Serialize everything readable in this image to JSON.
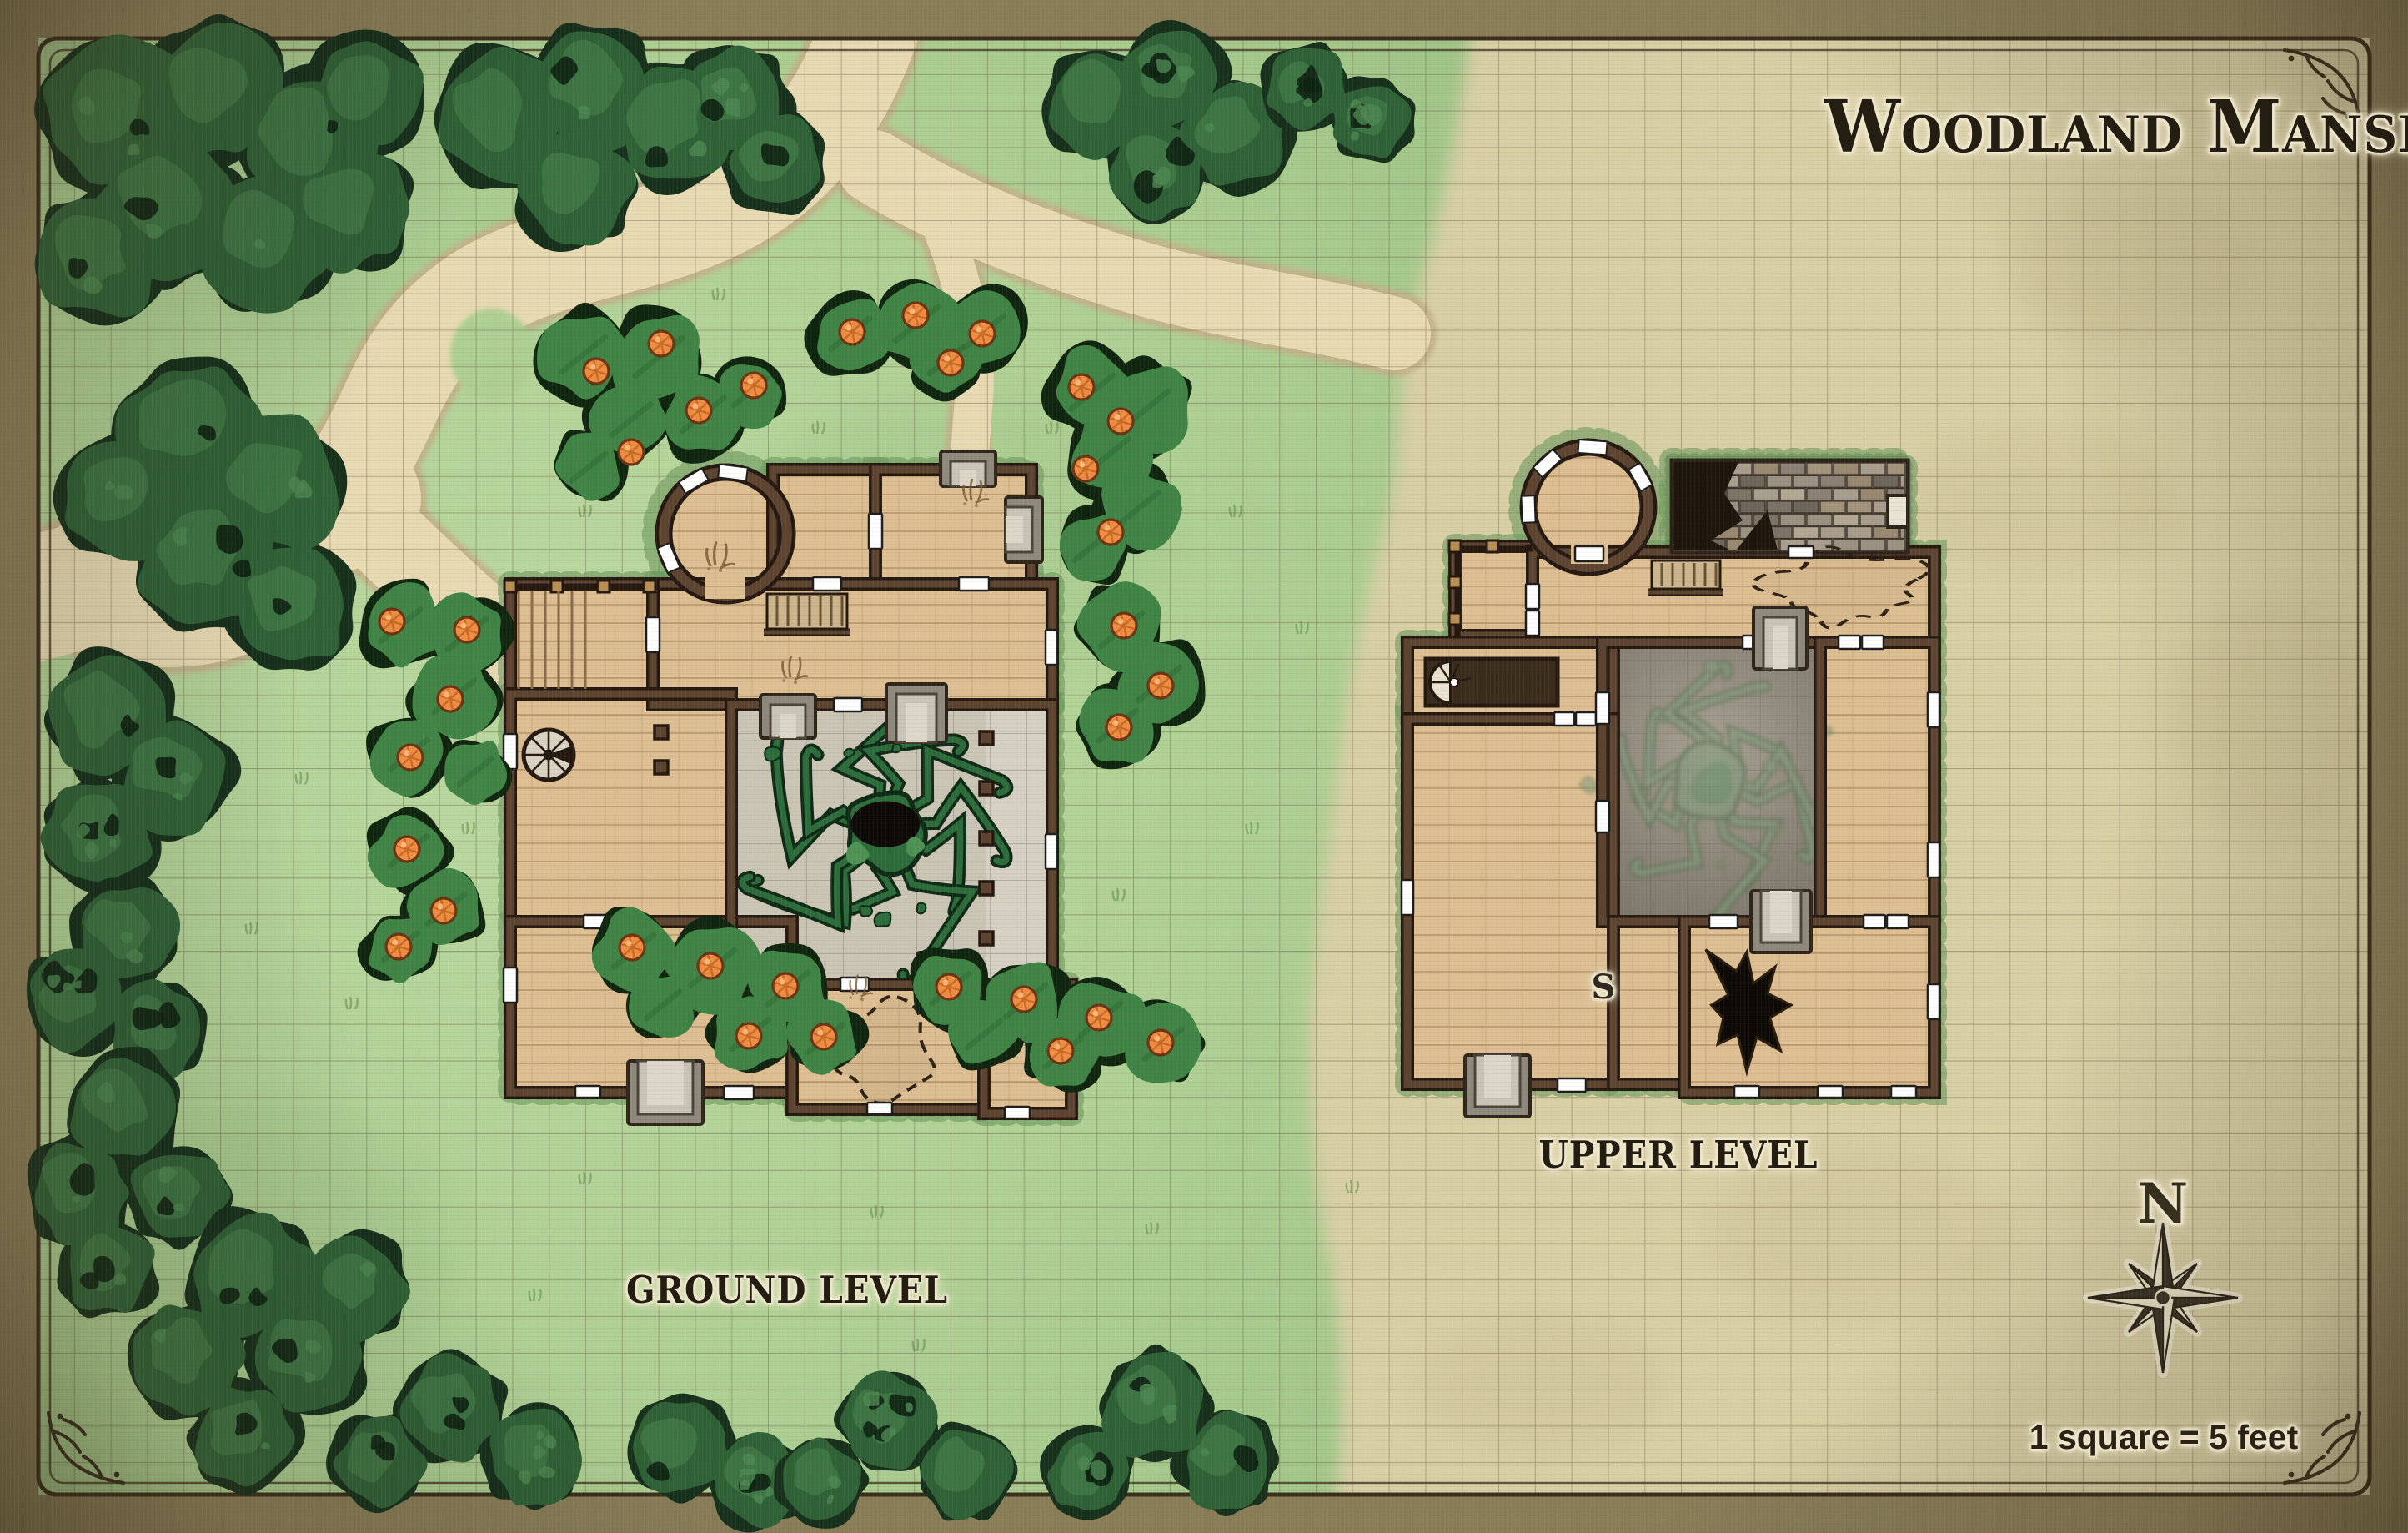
{
  "map": {
    "title": "Woodland Manse",
    "ground_level_label": "GROUND LEVEL",
    "upper_level_label": "UPPER LEVEL",
    "stairs_marker": "S",
    "compass": {
      "north_label": "N"
    },
    "scale_note": "1 square = 5 feet"
  },
  "colors": {
    "margin": "#897d58",
    "parchment": "#d8cfa5",
    "grass": "#aecf93",
    "grass_light": "#bcd9a2",
    "grass_dark": "#9cc285",
    "tree_outline": "#16301c",
    "tree_canopy": "#2f6136",
    "tree_mottle": "#3d7443",
    "tree_light": "#4c8751",
    "bush": "#3f8345",
    "bush_outline": "#10250f",
    "berry": "#ee8c43",
    "berry_rim": "#6b3312",
    "path_dirt": "#e7d9b2",
    "path_edge": "#c2b089",
    "grid_line": "#5c4a30",
    "wood_floor": "#dcbe92",
    "plank": "#7d542d",
    "wall": "#5d4430",
    "wall_outline": "#241810",
    "stone_floor": "#cac4b4",
    "stone_light": "#d7d2c3",
    "stone_porch": "#8f897d",
    "stone_porch_in": "#c9c3b6",
    "shaft_stone": "#8c8577",
    "door": "#ffffff",
    "vine_outline": "#0e2a16",
    "vine": "#2c6c3a",
    "vine_light": "#4e9154",
    "vine_faded": "#6b8a6e",
    "hole_black": "#0d0906",
    "ivy": "#6d975e",
    "rail": "#b98e55",
    "roof_dark": "#1e150c",
    "frame": "#392d1b",
    "ink": "#241d12",
    "halo": "#efe7cd",
    "compass_dark": "#3a3326",
    "compass_light": "#ebe3c6"
  }
}
